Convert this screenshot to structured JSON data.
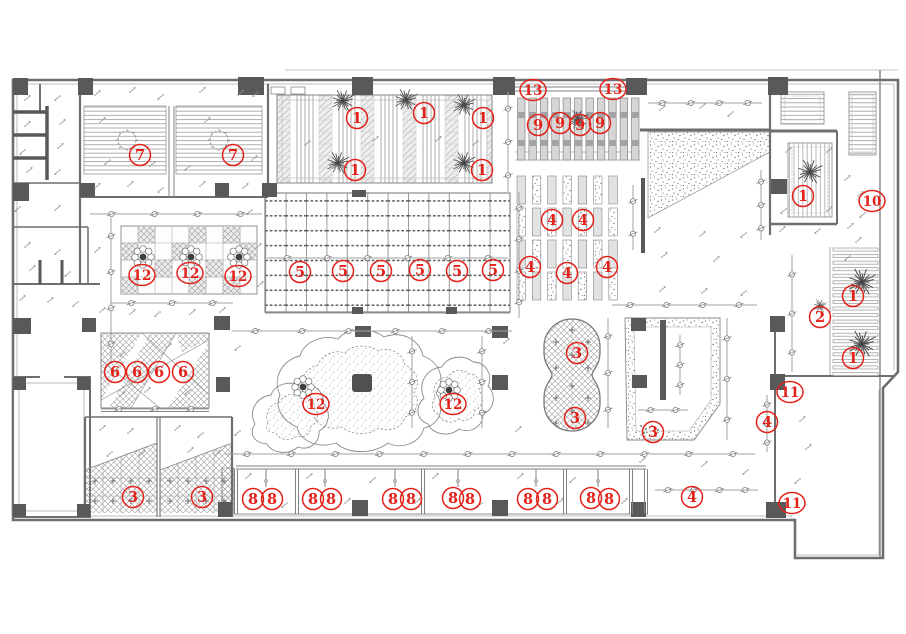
{
  "drawing": {
    "kind": "interior-ceiling-plan",
    "canvas": {
      "width": 906,
      "height": 634
    },
    "colors": {
      "callout_red": "#e32119",
      "wall_dark": "#58595b",
      "wall_line": "#6d6e71",
      "light_line": "#9fa1a3",
      "paper": "#ffffff"
    },
    "callouts": [
      {
        "n": "7",
        "x": 140,
        "y": 155
      },
      {
        "n": "7",
        "x": 233,
        "y": 155
      },
      {
        "n": "1",
        "x": 357,
        "y": 118
      },
      {
        "n": "1",
        "x": 424,
        "y": 113
      },
      {
        "n": "1",
        "x": 483,
        "y": 118
      },
      {
        "n": "1",
        "x": 355,
        "y": 170
      },
      {
        "n": "1",
        "x": 482,
        "y": 170
      },
      {
        "n": "13",
        "x": 533,
        "y": 90
      },
      {
        "n": "13",
        "x": 613,
        "y": 89
      },
      {
        "n": "9",
        "x": 538,
        "y": 125
      },
      {
        "n": "9",
        "x": 560,
        "y": 123
      },
      {
        "n": "9",
        "x": 580,
        "y": 125
      },
      {
        "n": "9",
        "x": 600,
        "y": 123
      },
      {
        "n": "4",
        "x": 552,
        "y": 220
      },
      {
        "n": "4",
        "x": 583,
        "y": 220
      },
      {
        "n": "4",
        "x": 530,
        "y": 267
      },
      {
        "n": "4",
        "x": 567,
        "y": 273
      },
      {
        "n": "4",
        "x": 607,
        "y": 267
      },
      {
        "n": "1",
        "x": 803,
        "y": 196
      },
      {
        "n": "10",
        "x": 872,
        "y": 201
      },
      {
        "n": "1",
        "x": 853,
        "y": 296
      },
      {
        "n": "2",
        "x": 820,
        "y": 317
      },
      {
        "n": "1",
        "x": 853,
        "y": 358
      },
      {
        "n": "12",
        "x": 142,
        "y": 275
      },
      {
        "n": "12",
        "x": 190,
        "y": 273
      },
      {
        "n": "12",
        "x": 238,
        "y": 276
      },
      {
        "n": "5",
        "x": 300,
        "y": 272
      },
      {
        "n": "5",
        "x": 343,
        "y": 271
      },
      {
        "n": "5",
        "x": 381,
        "y": 271
      },
      {
        "n": "5",
        "x": 420,
        "y": 270
      },
      {
        "n": "5",
        "x": 457,
        "y": 271
      },
      {
        "n": "5",
        "x": 493,
        "y": 270
      },
      {
        "n": "6",
        "x": 115,
        "y": 372
      },
      {
        "n": "6",
        "x": 137,
        "y": 372
      },
      {
        "n": "6",
        "x": 159,
        "y": 372
      },
      {
        "n": "6",
        "x": 183,
        "y": 372
      },
      {
        "n": "12",
        "x": 316,
        "y": 404
      },
      {
        "n": "12",
        "x": 453,
        "y": 404
      },
      {
        "n": "3",
        "x": 577,
        "y": 353
      },
      {
        "n": "3",
        "x": 575,
        "y": 418
      },
      {
        "n": "3",
        "x": 653,
        "y": 432
      },
      {
        "n": "4",
        "x": 767,
        "y": 422
      },
      {
        "n": "11",
        "x": 790,
        "y": 392
      },
      {
        "n": "3",
        "x": 133,
        "y": 497
      },
      {
        "n": "3",
        "x": 202,
        "y": 497
      },
      {
        "n": "8",
        "x": 253,
        "y": 499
      },
      {
        "n": "8",
        "x": 272,
        "y": 499
      },
      {
        "n": "8",
        "x": 313,
        "y": 499
      },
      {
        "n": "8",
        "x": 331,
        "y": 499
      },
      {
        "n": "8",
        "x": 393,
        "y": 499
      },
      {
        "n": "8",
        "x": 411,
        "y": 499
      },
      {
        "n": "8",
        "x": 453,
        "y": 498
      },
      {
        "n": "8",
        "x": 470,
        "y": 499
      },
      {
        "n": "8",
        "x": 528,
        "y": 499
      },
      {
        "n": "8",
        "x": 547,
        "y": 499
      },
      {
        "n": "8",
        "x": 591,
        "y": 498
      },
      {
        "n": "8",
        "x": 609,
        "y": 499
      },
      {
        "n": "4",
        "x": 692,
        "y": 497
      },
      {
        "n": "11",
        "x": 792,
        "y": 503
      }
    ]
  }
}
